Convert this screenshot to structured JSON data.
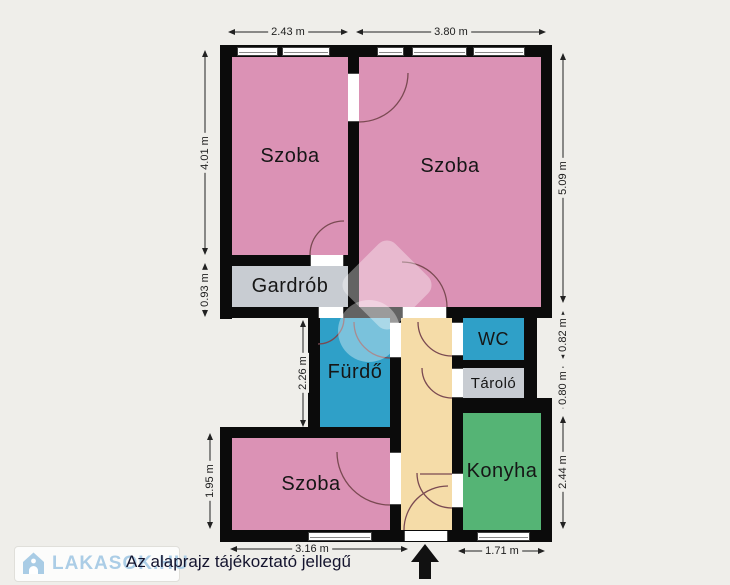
{
  "plan": {
    "rooms": {
      "szoba_tl": "Szoba",
      "szoba_tr": "Szoba",
      "gardrob": "Gardrób",
      "furdo": "Fürdő",
      "wc": "WC",
      "tarolo": "Tároló",
      "konyha": "Konyha",
      "szoba_b": "Szoba"
    },
    "dims": {
      "top_szoba_tl": "2.43 m",
      "top_szoba_tr": "3.80 m",
      "left_szoba_tl": "4.01 m",
      "left_gardrob": "0.93 m",
      "left_furdo": "2.26 m",
      "left_szoba_b": "1.95 m",
      "right_szoba_tr": "5.09 m",
      "right_wc": "0.82 m",
      "right_tarolo": "0.80 m",
      "right_konyha": "2.44 m",
      "bottom_szoba_b": "3.16 m",
      "bottom_konyha": "1.71 m"
    },
    "colors": {
      "room_pink": "#DB92B5",
      "room_blue": "#2FA0C8",
      "room_gray": "#C8CCD2",
      "room_tan": "#F5DCA8",
      "room_green": "#55B475",
      "wall": "#0B0B0B",
      "background": "#EFEEEA",
      "dimension_text": "#202020",
      "logo_blue": "#ABCDE6"
    }
  },
  "footer": {
    "logo_text": "LAKASOK.HU",
    "disclaimer": "Az alaprajz tájékoztató jellegű"
  }
}
